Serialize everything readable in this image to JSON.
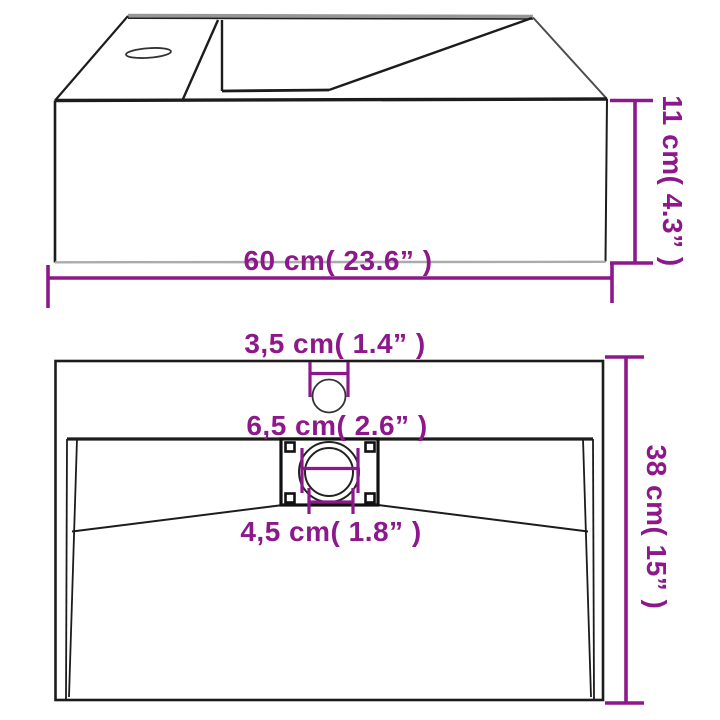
{
  "diagram": {
    "kind": "product-dimension-diagram",
    "subject": "wall-hung basin with faucet hole and drain",
    "colors": {
      "dimension": "#8D188B",
      "outline": "#1c1c1c",
      "shadow_line": "#ababab",
      "background": "#ffffff"
    },
    "perspective_view": {
      "width_label": "60 cm( 23.6” )",
      "height_label": "11 cm( 4.3” )"
    },
    "top_view": {
      "faucet_hole_label": "3,5 cm( 1.4” )",
      "drain_outer_label": "6,5 cm( 2.6” )",
      "drain_inner_label": "4,5 cm( 1.8” )",
      "depth_label": "38 cm( 15” )"
    }
  }
}
